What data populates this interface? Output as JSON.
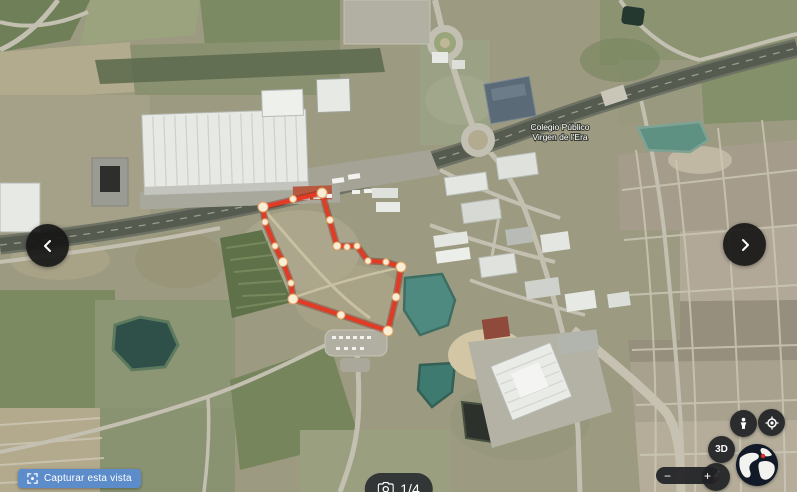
{
  "map": {
    "place_label": {
      "line1": "Colegio Público",
      "line2": "Virgen de l'Era"
    }
  },
  "capture": {
    "label": "Capturar esta vista",
    "icon": "screenshot-frame-icon"
  },
  "pagination": {
    "counter": "1/4",
    "icon": "camera-icon"
  },
  "navigation": {
    "prev_icon": "chevron-left-icon",
    "next_icon": "chevron-right-icon"
  },
  "controls": {
    "zoom_out_label": "−",
    "zoom_in_label": "+",
    "threed_label": "3D",
    "icons": [
      "pegman-icon",
      "my-location-icon",
      "compass-icon",
      "globe-icon"
    ]
  },
  "colors": {
    "annotation_red": "#e23a24",
    "annotation_dot": "#f8eed8",
    "capture_button_blue": "#5d8ccb",
    "pill_dark": "#2d2f32"
  },
  "annotation": {
    "type": "polygon",
    "points": [
      [
        263,
        207
      ],
      [
        322,
        193
      ],
      [
        337,
        246
      ],
      [
        357,
        246
      ],
      [
        368,
        261
      ],
      [
        386,
        262
      ],
      [
        401,
        267
      ],
      [
        396,
        297
      ],
      [
        388,
        331
      ],
      [
        341,
        315
      ],
      [
        293,
        299
      ],
      [
        291,
        283
      ],
      [
        283,
        262
      ],
      [
        275,
        246
      ],
      [
        265,
        222
      ]
    ],
    "dots": [
      [
        263,
        207,
        5
      ],
      [
        293,
        199,
        3.5
      ],
      [
        322,
        193,
        5
      ],
      [
        330,
        220,
        3.5
      ],
      [
        337,
        246,
        4
      ],
      [
        347,
        247,
        3.2
      ],
      [
        357,
        246,
        3.2
      ],
      [
        368,
        261,
        3.2
      ],
      [
        386,
        262,
        3.2
      ],
      [
        401,
        267,
        5
      ],
      [
        396,
        297,
        4
      ],
      [
        388,
        331,
        5
      ],
      [
        341,
        315,
        4
      ],
      [
        293,
        299,
        5
      ],
      [
        291,
        283,
        3.2
      ],
      [
        283,
        262,
        4.5
      ],
      [
        275,
        246,
        3.2
      ],
      [
        265,
        222,
        3.2
      ]
    ]
  }
}
